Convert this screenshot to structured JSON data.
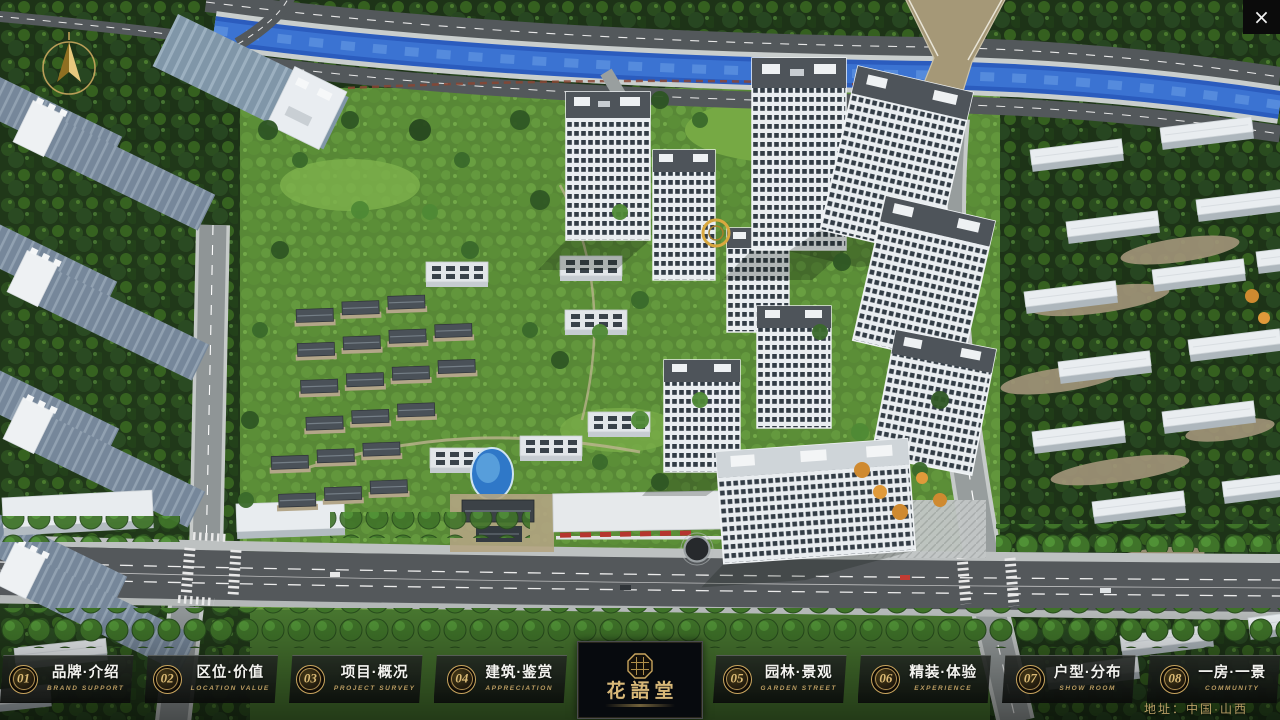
{
  "window": {
    "close_icon": "×"
  },
  "nav": {
    "items": [
      {
        "num": "01",
        "zh": "品牌·介绍",
        "en": "BRAND SUPPORT"
      },
      {
        "num": "02",
        "zh": "区位·价值",
        "en": "LOCATION VALUE"
      },
      {
        "num": "03",
        "zh": "项目·概况",
        "en": "PROJECT SURVEY"
      },
      {
        "num": "04",
        "zh": "建筑·鉴赏",
        "en": "APPRECIATION"
      },
      {
        "num": "05",
        "zh": "园林·景观",
        "en": "GARDEN STREET"
      },
      {
        "num": "06",
        "zh": "精装·体验",
        "en": "EXPERIENCE"
      },
      {
        "num": "07",
        "zh": "户型·分布",
        "en": "SHOW ROOM"
      },
      {
        "num": "08",
        "zh": "一房·一景",
        "en": "COMMUNITY"
      }
    ]
  },
  "logo": {
    "name": "花語堂"
  },
  "footer": {
    "address": "地址：中国·山西"
  },
  "palette": {
    "accent_gold": "#c9a55e",
    "bar_background": "#0c0e0c",
    "river_blue": "#2d5fc0",
    "foliage_dark": "#24401d",
    "foliage_light": "#527f34",
    "building_white": "#e8ecef",
    "asphalt_gray": "#54585b",
    "canopy_red": "#b5352e"
  },
  "icons": {
    "compass": "north-arrow",
    "brand_seal": "octagonal-seal"
  }
}
